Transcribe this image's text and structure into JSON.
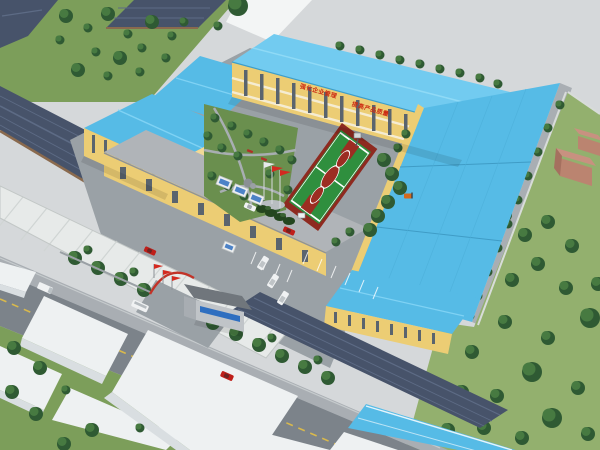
{
  "meta": {
    "description": "Aerial oblique 3D architectural rendering of a factory campus: yellow buildings with bright blue metal roofs around a courtyard garden and basketball court, front gate with red flags, public road with vehicles, dark tiled sheds to the north-west and village fields with brick houses to the east.",
    "width": 600,
    "height": 450
  },
  "slogan": {
    "line1": "强化企业管理",
    "line2": "提高产品质量",
    "color": "#cc2a12"
  },
  "colors": {
    "backdrop": "#d5d8da",
    "white_band": "#f3f5f5",
    "grass_left": "#7c9e5a",
    "grass_right": "#93b06e",
    "garden_green": "#6a8f4e",
    "tree_dark": "#2f5a33",
    "tree_mid": "#477a41",
    "roof_blue": "#56bbe6",
    "roof_blue_light": "#72cbf0",
    "wall_yellow": "#eccd74",
    "wall_cream": "#f5ecd2",
    "window_gray": "#5a646e",
    "flat_roof_gray": "#b0b4b8",
    "dark_tile_roof": "#47536a",
    "tile_ridge": "#5d6b85",
    "roof_trim_brown": "#8a6a4e",
    "pavement": "#9aa1a6",
    "road_asphalt": "#7c838a",
    "road_line_yellow": "#d9b94c",
    "sidewalk": "#a9aeb3",
    "canopy_white": "#e7eae9",
    "canopy_stripe": "#d0d5d4",
    "white_building_top": "#eef1f2",
    "white_building_side": "#d9dee1",
    "court_green": "#2f8f3e",
    "court_red": "#9c2d22",
    "court_line": "#ffffff",
    "brick_wall": "#bb8470",
    "brick_roof": "#c89180",
    "flag_red": "#d42a20",
    "sign_blue": "#2f6fc0",
    "car_red": "#bf1f1a",
    "vehicle_white": "#f0f2f3",
    "forklift_orange": "#d2691e"
  },
  "objects": {
    "main_building": "main office / production building with roof slogan wall",
    "big_hall": "large workshop hall with blue roof",
    "left_wing": "west wing building",
    "low_workshop": "single-storey workshop with flat grey roof",
    "south_workshop": "south workshop",
    "farm_sheds": "dark tiled sheds north-west of campus",
    "canopy": "long white canopy shed",
    "basketball_court": "green basketball court with red keys",
    "courtyard_garden": "landscaped courtyard garden",
    "flagpoles": "three flag poles on plaza",
    "display_boards": "publicity display boards",
    "gatehouse": "gate house with blue sign",
    "gate_flags": "red flags at entrance gate",
    "public_road": "public road with dashed centre line",
    "brick_houses": "village brick houses east of wall",
    "vehicles": [
      "red car on road",
      "red car at gate",
      "red car in yard",
      "white car",
      "white van",
      "white van",
      "white van",
      "white bus at gate apron",
      "white truck",
      "forklift"
    ]
  }
}
